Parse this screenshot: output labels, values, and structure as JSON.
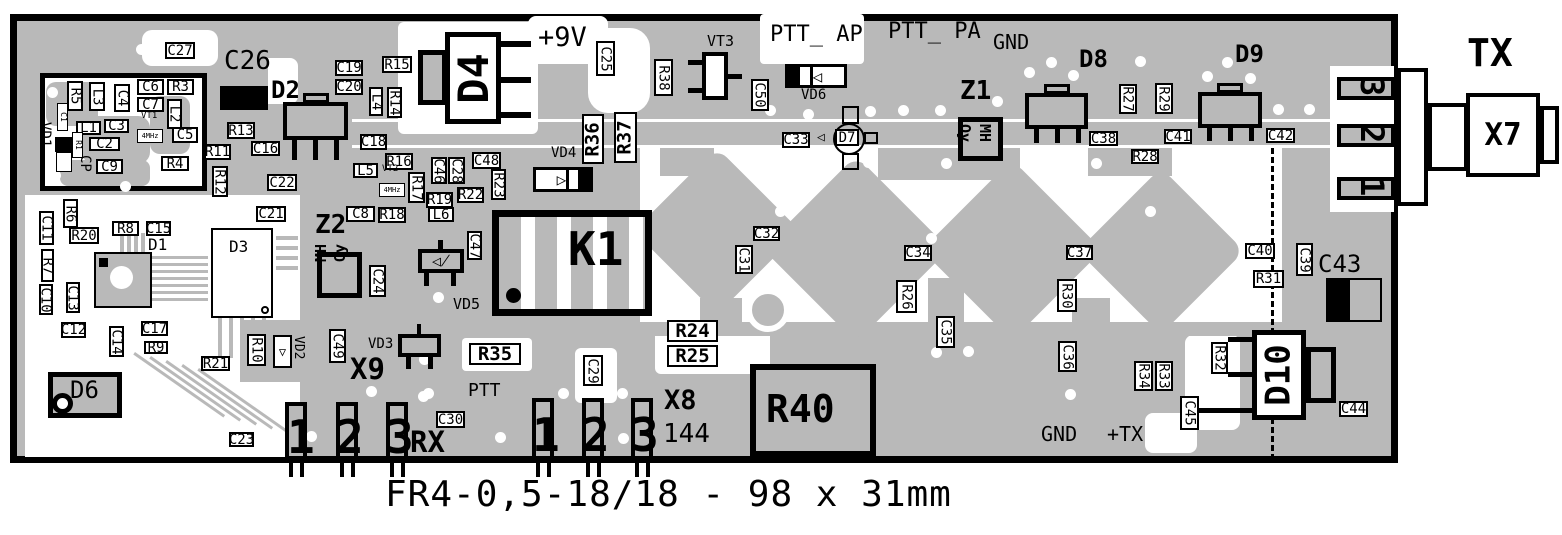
{
  "board": {
    "caption": "FR4-0,5-18/18 - 98 x 31mm",
    "colors": {
      "board_gray": "#b9b9b9",
      "clearance_white": "#ffffff",
      "silkscreen_black": "#000000"
    }
  },
  "connectors": {
    "x7": {
      "label": "X7",
      "signal": "TX",
      "edge_pads": [
        "3",
        "2",
        "1"
      ]
    },
    "x9": {
      "label": "X9",
      "signal": "RX",
      "pins": [
        "1",
        "2",
        "3"
      ]
    },
    "x8": {
      "label": "X8",
      "band": "144",
      "pins": [
        "1",
        "2",
        "3"
      ]
    }
  },
  "annotations": {
    "boxed": [
      [
        "C27",
        165,
        42,
        30,
        17,
        "h",
        "box"
      ],
      [
        "C19",
        335,
        60,
        28,
        16,
        "h",
        "box"
      ],
      [
        "C20",
        335,
        79,
        28,
        16,
        "h",
        "box"
      ],
      [
        "R15",
        382,
        56,
        30,
        17,
        "h",
        "box"
      ],
      [
        "L4",
        369,
        87,
        14,
        29,
        "v",
        "box"
      ],
      [
        "R14",
        387,
        87,
        15,
        31,
        "v",
        "box"
      ],
      [
        "C18",
        360,
        134,
        27,
        16,
        "h",
        "box"
      ],
      [
        "R16",
        385,
        153,
        28,
        17,
        "h",
        "box"
      ],
      [
        "L5",
        353,
        163,
        25,
        15,
        "h",
        "box"
      ],
      [
        "4MHz",
        379,
        183,
        26,
        14,
        "h",
        "tiny"
      ],
      [
        "R17",
        408,
        172,
        17,
        31,
        "v",
        "box"
      ],
      [
        "C46",
        431,
        157,
        16,
        27,
        "v",
        "box"
      ],
      [
        "C28",
        448,
        157,
        17,
        27,
        "v",
        "box"
      ],
      [
        "C48",
        472,
        152,
        29,
        17,
        "h",
        "box"
      ],
      [
        "R23",
        491,
        169,
        15,
        31,
        "v",
        "box"
      ],
      [
        "R19",
        426,
        192,
        27,
        16,
        "h",
        "box"
      ],
      [
        "R22",
        457,
        187,
        27,
        16,
        "h",
        "box"
      ],
      [
        "L6",
        428,
        207,
        26,
        15,
        "h",
        "box"
      ],
      [
        "C47",
        467,
        231,
        15,
        29,
        "v",
        "box"
      ],
      [
        "R13",
        227,
        122,
        28,
        17,
        "h",
        "box"
      ],
      [
        "C16",
        251,
        141,
        29,
        15,
        "h",
        "box"
      ],
      [
        "R11",
        204,
        144,
        27,
        16,
        "h",
        "box"
      ],
      [
        "R12",
        212,
        166,
        16,
        31,
        "v",
        "box"
      ],
      [
        "C22",
        267,
        174,
        30,
        17,
        "h",
        "box"
      ],
      [
        "C21",
        256,
        206,
        30,
        16,
        "h",
        "box"
      ],
      [
        "C8",
        346,
        206,
        29,
        16,
        "h",
        "box"
      ],
      [
        "R18",
        378,
        207,
        28,
        16,
        "h",
        "box"
      ],
      [
        "C6",
        137,
        79,
        27,
        16,
        "h",
        "box"
      ],
      [
        "R3",
        167,
        79,
        27,
        16,
        "h",
        "box"
      ],
      [
        "C7",
        137,
        97,
        27,
        15,
        "h",
        "box"
      ],
      [
        "C5",
        172,
        127,
        26,
        16,
        "h",
        "box"
      ],
      [
        "L1",
        76,
        121,
        25,
        14,
        "h",
        "box"
      ],
      [
        "C3",
        104,
        119,
        25,
        14,
        "h",
        "box"
      ],
      [
        "C2",
        89,
        137,
        31,
        14,
        "h",
        "box"
      ],
      [
        "C9",
        96,
        159,
        27,
        15,
        "h",
        "box"
      ],
      [
        "R4",
        161,
        156,
        28,
        15,
        "h",
        "box"
      ],
      [
        "R5",
        67,
        81,
        16,
        30,
        "v",
        "box"
      ],
      [
        "L3",
        89,
        82,
        16,
        29,
        "v",
        "box"
      ],
      [
        "C4",
        114,
        84,
        16,
        28,
        "v",
        "box"
      ],
      [
        "L2",
        167,
        99,
        15,
        30,
        "v",
        "box"
      ],
      [
        "C1",
        57,
        103,
        11,
        28,
        "v",
        "tiny"
      ],
      [
        "R1",
        72,
        132,
        11,
        26,
        "v",
        "tiny"
      ],
      [
        "4MHz",
        137,
        129,
        26,
        14,
        "h",
        "tiny"
      ],
      [
        "R6",
        63,
        199,
        15,
        29,
        "v",
        "box"
      ],
      [
        "C11",
        39,
        211,
        15,
        34,
        "v",
        "box"
      ],
      [
        "R20",
        69,
        227,
        30,
        17,
        "h",
        "box"
      ],
      [
        "R7",
        41,
        249,
        13,
        33,
        "v",
        "box"
      ],
      [
        "C10",
        39,
        284,
        14,
        31,
        "v",
        "box"
      ],
      [
        "C13",
        66,
        282,
        14,
        31,
        "v",
        "box"
      ],
      [
        "R8",
        112,
        221,
        27,
        15,
        "h",
        "box"
      ],
      [
        "C15",
        146,
        221,
        25,
        15,
        "h",
        "box"
      ],
      [
        "C12",
        61,
        322,
        25,
        16,
        "h",
        "box"
      ],
      [
        "C14",
        109,
        326,
        15,
        31,
        "v",
        "box"
      ],
      [
        "C17",
        141,
        321,
        27,
        15,
        "h",
        "box"
      ],
      [
        "R9",
        144,
        341,
        24,
        13,
        "h",
        "box"
      ],
      [
        "R21",
        201,
        356,
        29,
        15,
        "h",
        "box"
      ],
      [
        "C23",
        229,
        432,
        25,
        15,
        "h",
        "box"
      ],
      [
        "R10",
        247,
        334,
        19,
        32,
        "v",
        "box"
      ],
      [
        "C49",
        329,
        329,
        17,
        34,
        "v",
        "box"
      ],
      [
        "C24",
        369,
        265,
        17,
        32,
        "v",
        "box"
      ],
      [
        "C25",
        596,
        41,
        19,
        35,
        "v",
        "box"
      ],
      [
        "R38",
        654,
        59,
        19,
        37,
        "v",
        "box"
      ],
      [
        "C50",
        751,
        79,
        18,
        32,
        "v",
        "box"
      ],
      [
        "C33",
        782,
        132,
        28,
        16,
        "h",
        "box"
      ],
      [
        "D7",
        835,
        129,
        24,
        17,
        "h",
        "box"
      ],
      [
        "C38",
        1089,
        131,
        29,
        15,
        "h",
        "box"
      ],
      [
        "R28",
        1131,
        149,
        28,
        15,
        "h",
        "box"
      ],
      [
        "R27",
        1119,
        84,
        18,
        30,
        "v",
        "box"
      ],
      [
        "R29",
        1155,
        83,
        18,
        31,
        "v",
        "box"
      ],
      [
        "C41",
        1164,
        129,
        28,
        15,
        "h",
        "box"
      ],
      [
        "C42",
        1266,
        128,
        29,
        15,
        "h",
        "box"
      ],
      [
        "C40",
        1245,
        243,
        30,
        16,
        "h",
        "box"
      ],
      [
        "C39",
        1296,
        243,
        17,
        33,
        "v",
        "box"
      ],
      [
        "R31",
        1253,
        270,
        31,
        18,
        "h",
        "box"
      ],
      [
        "C34",
        904,
        245,
        28,
        16,
        "h",
        "box"
      ],
      [
        "R26",
        896,
        280,
        21,
        33,
        "v",
        "box"
      ],
      [
        "C35",
        936,
        316,
        19,
        32,
        "v",
        "box"
      ],
      [
        "C37",
        1066,
        245,
        27,
        15,
        "h",
        "box"
      ],
      [
        "R30",
        1057,
        279,
        20,
        33,
        "v",
        "box"
      ],
      [
        "C36",
        1058,
        341,
        19,
        31,
        "v",
        "box"
      ],
      [
        "R34",
        1134,
        361,
        19,
        30,
        "v",
        "box"
      ],
      [
        "R33",
        1155,
        361,
        18,
        30,
        "v",
        "box"
      ],
      [
        "R32",
        1211,
        342,
        17,
        32,
        "v",
        "box"
      ],
      [
        "C45",
        1180,
        396,
        19,
        34,
        "v",
        "box"
      ],
      [
        "C44",
        1339,
        401,
        29,
        16,
        "h",
        "box"
      ],
      [
        "C30",
        436,
        411,
        29,
        17,
        "h",
        "box"
      ],
      [
        "C29",
        583,
        355,
        20,
        31,
        "v",
        "box"
      ],
      [
        "C31",
        735,
        245,
        18,
        29,
        "v",
        "box"
      ],
      [
        "C32",
        753,
        226,
        27,
        15,
        "h",
        "box"
      ],
      [
        "R35",
        469,
        343,
        52,
        22,
        "h",
        "bold"
      ],
      [
        "R24",
        667,
        320,
        51,
        22,
        "h",
        "bold"
      ],
      [
        "R25",
        667,
        345,
        51,
        22,
        "h",
        "bold"
      ],
      [
        "R36",
        582,
        114,
        22,
        50,
        "vb",
        "bold"
      ],
      [
        "R37",
        614,
        112,
        23,
        51,
        "vb",
        "bold"
      ]
    ],
    "texts": [
      [
        "D2",
        271,
        78,
        24,
        "bold",
        ""
      ],
      [
        "D8",
        1079,
        47,
        24,
        "bold",
        ""
      ],
      [
        "D9",
        1235,
        42,
        24,
        "bold",
        ""
      ],
      [
        "Z1",
        960,
        78,
        26,
        "bold",
        ""
      ],
      [
        "Z2",
        315,
        212,
        26,
        "bold",
        ""
      ],
      [
        "D6",
        70,
        378,
        24,
        "normal",
        ""
      ],
      [
        "D1",
        148,
        237,
        16,
        "normal",
        ""
      ],
      [
        "D3",
        229,
        239,
        16,
        "normal",
        ""
      ],
      [
        "VD1",
        38,
        122,
        14,
        "normal",
        "90"
      ],
      [
        "VD2",
        292,
        336,
        13,
        "normal",
        "90"
      ],
      [
        "VD3",
        368,
        337,
        14,
        "normal",
        ""
      ],
      [
        "VD4",
        551,
        146,
        14,
        "normal",
        ""
      ],
      [
        "VD5",
        453,
        297,
        15,
        "normal",
        ""
      ],
      [
        "VD6",
        801,
        88,
        14,
        "normal",
        ""
      ],
      [
        "VT1",
        141,
        112,
        9,
        "normal",
        ""
      ],
      [
        "VT2",
        382,
        165,
        9,
        "normal",
        ""
      ],
      [
        "VT3",
        707,
        34,
        15,
        "normal",
        ""
      ],
      [
        "CP",
        78,
        155,
        14,
        "normal",
        "90"
      ],
      [
        "+9V",
        538,
        24,
        27,
        "normal",
        ""
      ],
      [
        "PTT_ AP",
        770,
        24,
        22,
        "normal",
        ""
      ],
      [
        "PTT_ PA",
        888,
        21,
        22,
        "normal",
        ""
      ],
      [
        "GND",
        993,
        32,
        20,
        "normal",
        ""
      ],
      [
        "GND",
        1041,
        424,
        20,
        "normal",
        ""
      ],
      [
        "+TX",
        1107,
        424,
        20,
        "normal",
        ""
      ],
      [
        "PTT",
        468,
        382,
        18,
        "normal",
        ""
      ],
      [
        "RX",
        410,
        428,
        29,
        "bold",
        ""
      ],
      [
        "X9",
        350,
        355,
        29,
        "bold",
        ""
      ],
      [
        "X8",
        664,
        387,
        27,
        "bold",
        ""
      ],
      [
        "144",
        663,
        421,
        26,
        "normal",
        ""
      ],
      [
        "TX",
        1467,
        34,
        38,
        "bold",
        ""
      ],
      [
        "C43",
        1318,
        252,
        24,
        "normal",
        ""
      ],
      [
        "C26",
        224,
        48,
        26,
        "normal",
        ""
      ],
      [
        "K1",
        568,
        226,
        46,
        "bold",
        ""
      ],
      [
        "R40",
        766,
        390,
        38,
        "bold",
        ""
      ],
      [
        "Oy",
        957,
        124,
        15,
        "bold",
        "90"
      ],
      [
        "MH",
        977,
        124,
        15,
        "bold",
        "90"
      ],
      [
        "Oy",
        333,
        262,
        15,
        "bold",
        "-90"
      ],
      [
        "MH",
        314,
        262,
        15,
        "bold",
        "-90"
      ],
      [
        "1",
        287,
        414,
        46,
        "bold",
        ""
      ],
      [
        "2",
        336,
        414,
        46,
        "bold",
        ""
      ],
      [
        "3",
        386,
        414,
        46,
        "bold",
        ""
      ],
      [
        "1",
        532,
        412,
        46,
        "bold",
        ""
      ],
      [
        "2",
        582,
        412,
        46,
        "bold",
        ""
      ],
      [
        "3",
        631,
        412,
        46,
        "bold",
        ""
      ],
      [
        "3",
        1356,
        77,
        32,
        "bold",
        "90"
      ],
      [
        "2",
        1356,
        124,
        32,
        "bold",
        "90"
      ],
      [
        "1",
        1356,
        177,
        32,
        "bold",
        "90"
      ]
    ],
    "rotated_big": [
      [
        "D4",
        445,
        32,
        56,
        92,
        42
      ],
      [
        "D10",
        1252,
        330,
        54,
        90,
        34
      ],
      [
        "X7",
        1466,
        93,
        74,
        84,
        31
      ]
    ]
  }
}
